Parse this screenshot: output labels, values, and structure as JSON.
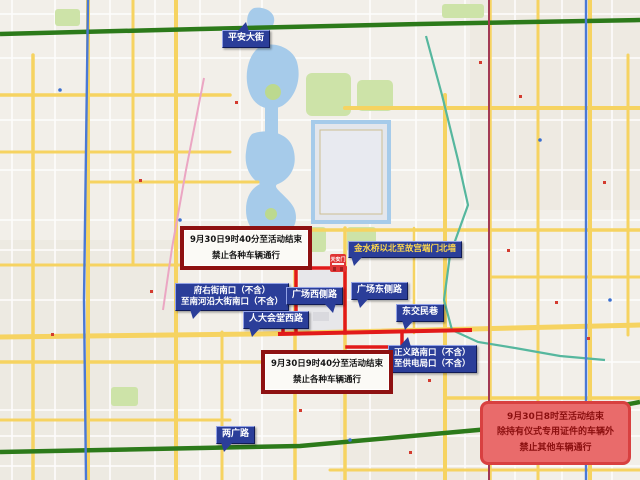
{
  "labels": {
    "pingan": {
      "text": "平安大街"
    },
    "jinshui": {
      "text": "金水桥以北至故宫端门北墙"
    },
    "fuyou": {
      "line1": "府右街南口（不含）",
      "line2": "至南河沿大街南口（不含）"
    },
    "guangchang_xi": {
      "text": "广场西侧路"
    },
    "guangchang_dong": {
      "text": "广场东侧路"
    },
    "renda_xi": {
      "text": "人大会堂西路"
    },
    "dongjiaomin": {
      "text": "东交民巷"
    },
    "zhengyi": {
      "line1": "正义路南口（不含）",
      "line2": "至供电局口（不含）"
    },
    "liangguang": {
      "text": "两广路"
    }
  },
  "notices": {
    "top": {
      "line1": "9月30日9时40分至活动结束",
      "line2": "禁止各种车辆通行"
    },
    "bottom": {
      "line1": "9月30日9时40分至活动结束",
      "line2": "禁止各种车辆通行"
    },
    "special": {
      "line1": "9月30日8时至活动结束",
      "line2": "除持有仪式专用证件的车辆外",
      "line3": "禁止其他车辆通行"
    }
  },
  "landmark": {
    "tiananmen": "天安门"
  },
  "colors": {
    "label_bg": "#2b3e99",
    "label_text": "#ffffff",
    "label_gold_text": "#ffd84d",
    "notice_border": "#8e1111",
    "notice_bg": "#fbfaf6",
    "special_bg": "#e96b6b",
    "special_border": "#d84040",
    "special_text": "#8b0f0f",
    "restricted_road": "#e21a1a",
    "major_road": "#f6d361",
    "green_road": "#2c7a1a",
    "water": "#a6cbea",
    "park": "#cde3a8"
  }
}
